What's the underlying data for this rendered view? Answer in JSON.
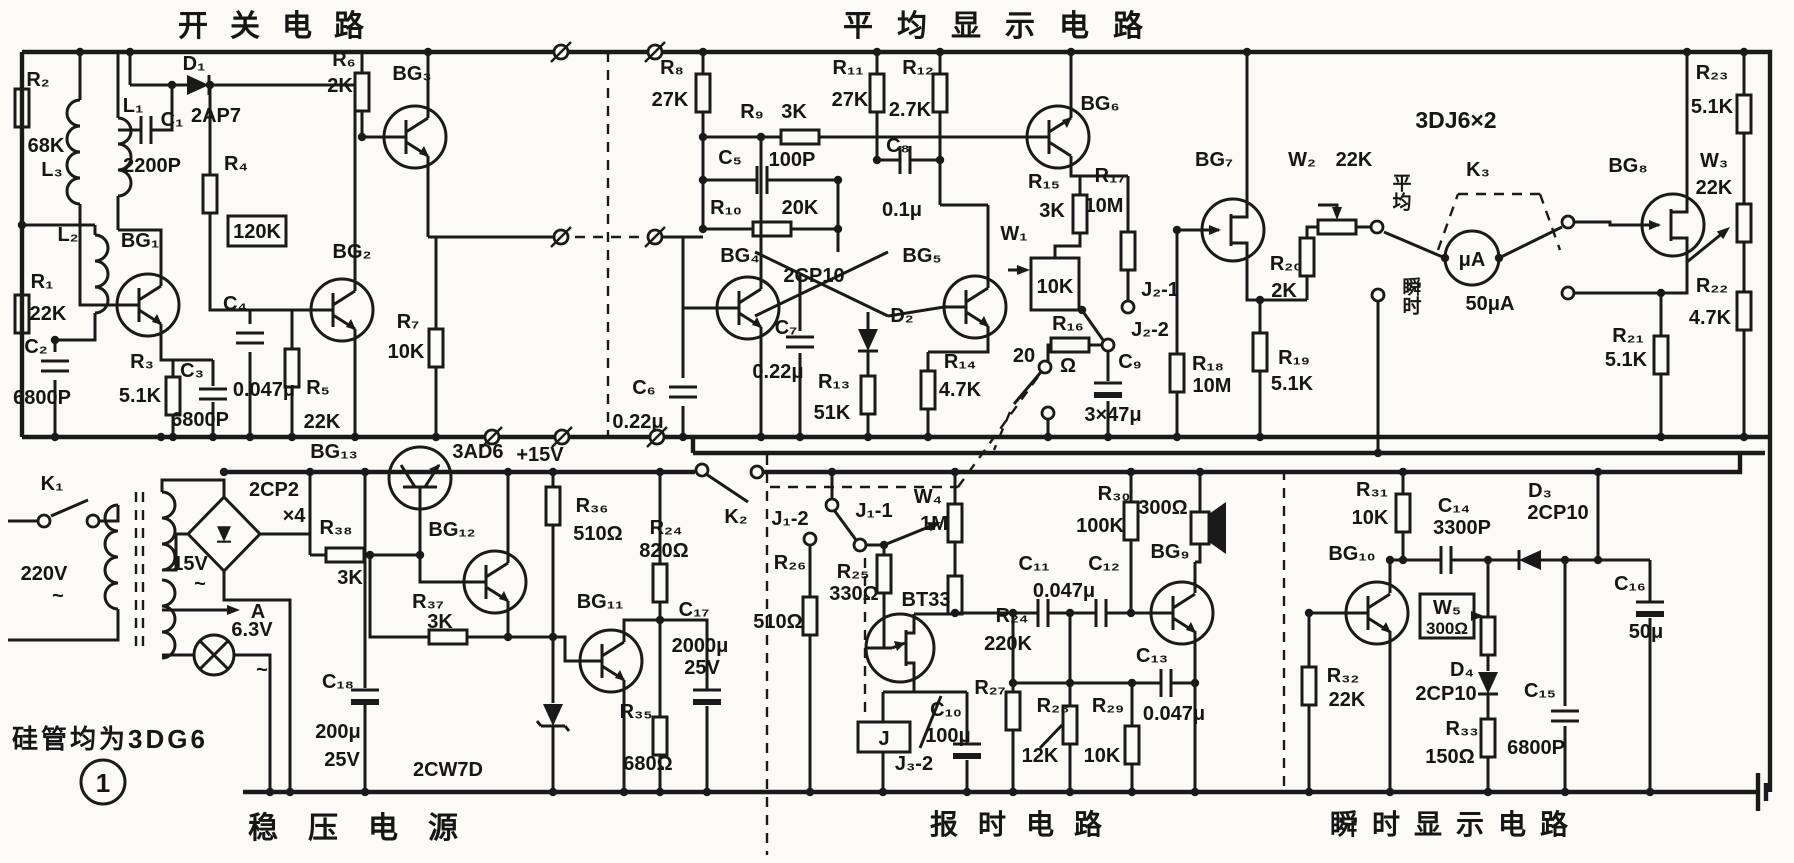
{
  "colors": {
    "ink": "#1a1a1a",
    "paper": "#fbfaf7"
  },
  "titles": {
    "switch_circuit": "开关电路",
    "average_display": "平均显示电路",
    "power_supply": "稳压电源",
    "chime": "报时电路",
    "instant_display": "瞬时显示电路"
  },
  "notes": {
    "transistors": "硅管均为3DG6",
    "figure": "1"
  },
  "sw": {
    "r2": "R₂",
    "r2v": "68K",
    "l3": "L₃",
    "l1": "L₁",
    "c1": "C₁",
    "c1v": "2200P",
    "d1": "D₁",
    "d1v": "2AP7",
    "r4": "R₄",
    "r4v": "120K",
    "r6": "R₆",
    "r6v": "2K",
    "bg3": "BG₃",
    "bg2": "BG₂",
    "bg1": "BG₁",
    "l2": "L₂",
    "r1": "R₁",
    "r1v": "22K",
    "c2": "C₂",
    "c2v": "6800P",
    "r3": "R₃",
    "r3v": "5.1K",
    "c3": "C₃",
    "c3v": "6800P",
    "c4": "C₄",
    "c4v": "0.047μ",
    "r5": "R₅",
    "r5v": "22K",
    "r7": "R₇",
    "r7v": "10K"
  },
  "psu": {
    "k1": "K₁",
    "v220": "220V",
    "v220t": "~",
    "v15": "15V",
    "v15t": "~",
    "rect": "2CP2",
    "rectx": "×4",
    "pa": "A",
    "v63": "6.3V",
    "v63t": "~",
    "bg13": "BG₁₃",
    "bg13t": "3AD6",
    "p15": "+15V",
    "r38": "R₃₈",
    "r38v": "3K",
    "bg12": "BG₁₂",
    "r37": "R₃₇",
    "r37v": "3K",
    "bg11": "BG₁₁",
    "r36": "R₃₆",
    "r36v": "510Ω",
    "r24": "R₂₄",
    "r24v": "820Ω",
    "c17": "C₁₇",
    "c17v": "2000μ",
    "c17u": "25V",
    "r35": "R₃₅",
    "r35v": "680Ω",
    "dz": "2CW7D",
    "c18": "C₁₈",
    "c18v": "200μ",
    "c18u": "25V"
  },
  "avg": {
    "r8": "R₈",
    "r8v": "27K",
    "r9": "R₉",
    "r9v": "3K",
    "c5": "C₅",
    "c5v": "100P",
    "r10": "R₁₀",
    "r10v": "20K",
    "r11": "R₁₁",
    "r11v": "27K",
    "r12": "R₁₂",
    "r12v": "2.7K",
    "c8": "C₈",
    "c8v": "0.1μ",
    "bg4": "BG₄",
    "bg5": "BG₅",
    "d2": "D₂",
    "d2v": "2CP10",
    "c6": "C₆",
    "c6v": "0.22μ",
    "c7": "C₇",
    "c7v": "0.22μ",
    "r13": "R₁₃",
    "r13v": "51K",
    "r14": "R₁₄",
    "r14v": "4.7K",
    "bg6": "BG₆",
    "r15": "R₁₅",
    "r15v": "3K",
    "r17": "R₁₇",
    "r17v": "10M",
    "w1": "W₁",
    "w1v": "10K",
    "j21": "J₂-1",
    "j22": "J₂-2",
    "r16": "R₁₆",
    "r16a": "20",
    "r16b": "Ω",
    "c9": "C₉",
    "c9v": "3×47μ",
    "bg7": "BG₇",
    "r20": "R₂₀",
    "r20v": "2K",
    "w2": "W₂",
    "w2v": "22K",
    "swavg": "平均",
    "swinst": "瞬时",
    "k3": "K₃",
    "fets": "3DJ6×2",
    "meter_unit": "μA",
    "meter_range": "50μA",
    "bg8": "BG₈",
    "r23": "R₂₃",
    "r23v": "5.1K",
    "w3": "W₃",
    "w3v": "22K",
    "r22": "R₂₂",
    "r22v": "4.7K",
    "r21": "R₂₁",
    "r21v": "5.1K",
    "r18": "R₁₈",
    "r18v": "10M",
    "r19": "R₁₉",
    "r19v": "5.1K"
  },
  "chime": {
    "k2": "K₂",
    "j11": "J₁-1",
    "j12": "J₁-2",
    "r25": "R₂₅",
    "r25v": "330Ω",
    "r26": "R₂₆",
    "r26v": "510Ω",
    "w4": "W₄",
    "w4v": "1M",
    "bt33": "BT33",
    "r24": "R₂₄",
    "r24v": "220K",
    "r27": "R₂₇",
    "c10": "C₁₀",
    "c10v": "100μ",
    "relay": "J",
    "j32": "J₃-2",
    "r28": "R₂₈",
    "r28v": "12K",
    "r29": "R₂₉",
    "r29v": "10K",
    "c11": "C₁₁",
    "c12": "C₁₂",
    "c1112v": "0.047μ",
    "c13": "C₁₃",
    "c13v": "0.047μ",
    "bg9": "BG₉",
    "r30": "R₃₀",
    "r30v": "100K",
    "spk": "300Ω"
  },
  "inst": {
    "r31": "R₃₁",
    "r31v": "10K",
    "c14": "C₁₄",
    "c14v": "3300P",
    "d3": "D₃",
    "d3v": "2CP10",
    "bg10": "BG₁₀",
    "w5": "W₅",
    "w5v": "300Ω",
    "d4": "D₄",
    "d4v": "2CP10",
    "r33": "R₃₃",
    "r33v": "150Ω",
    "c15": "C₁₅",
    "c15v": "6800P",
    "c16": "C₁₆",
    "c16v": "50μ",
    "r32": "R₃₂",
    "r32v": "22K"
  }
}
